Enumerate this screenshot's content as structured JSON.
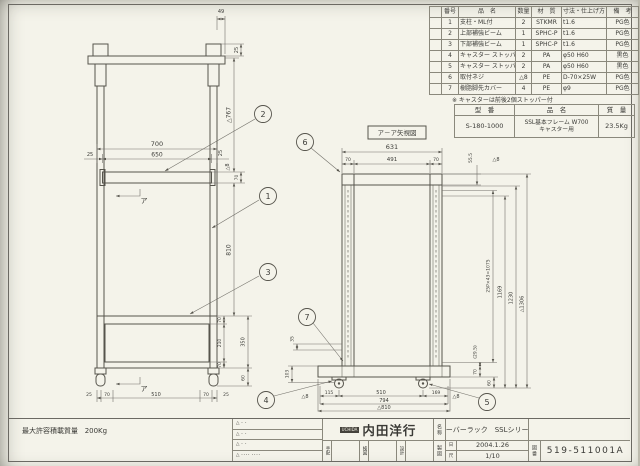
{
  "colors": {
    "paper": "#f4f3ea",
    "line": "#56544c",
    "dim": "#73716a",
    "text": "#3a3a36"
  },
  "front_view": {
    "callouts": {
      "c1": "1",
      "c2": "2",
      "c3": "3"
    },
    "section_label": "ア",
    "dims": {
      "d49": "49",
      "d25cap": "25",
      "d767": "△767",
      "d700": "700",
      "d650": "650",
      "d25l": "25",
      "d25r": "25",
      "d8": "△8",
      "d70beam": "70",
      "d810": "810",
      "d70a": "70",
      "d210": "210",
      "d70b": "70",
      "d350": "350",
      "d60": "60",
      "b25l": "25",
      "b70l": "70",
      "b510": "510",
      "b70r": "70",
      "b25r": "25"
    }
  },
  "side_view": {
    "title": "ア－ア矢視図",
    "callouts": {
      "c4": "4",
      "c5": "5",
      "c6": "6",
      "c7": "7"
    },
    "dims": {
      "d631": "631",
      "d70l": "70",
      "d491": "491",
      "d70r": "70",
      "d55": "55.5",
      "d8top": "△8",
      "pitch": "25P×43=1075",
      "d1169": "1169",
      "d1230": "1230",
      "d1306": "△1306",
      "d29": "(29.5)",
      "d70base": "70",
      "d60": "60",
      "d35": "35",
      "d103": "103",
      "d8l": "△8",
      "d8r": "△8",
      "b115": "115",
      "b510": "510",
      "b169": "169",
      "b794": "794",
      "b810": "△810"
    }
  },
  "parts_table": {
    "headers": {
      "sym": "",
      "no": "番号",
      "name": "品　名",
      "qty": "数量",
      "mat": "材　質",
      "dim": "寸法・仕上げ方",
      "note": "備　考"
    },
    "rows": [
      {
        "sym": "",
        "no": "1",
        "name": "支柱・ML付",
        "qty": "2",
        "mat": "STKMR",
        "dim": "t1.6",
        "note": "PG色"
      },
      {
        "sym": "",
        "no": "2",
        "name": "上部補強ビーム",
        "qty": "1",
        "mat": "SPHC-P",
        "dim": "t1.6",
        "note": "PG色"
      },
      {
        "sym": "",
        "no": "3",
        "name": "下部補強ビーム",
        "qty": "1",
        "mat": "SPHC-P",
        "dim": "t1.6",
        "note": "PG色"
      },
      {
        "sym": "",
        "no": "4",
        "name": "キャスター ストッパー付",
        "qty": "2",
        "mat": "PA",
        "dim": "φ50 H60",
        "note": "黒色"
      },
      {
        "sym": "",
        "no": "5",
        "name": "キャスター ストッパーなし",
        "qty": "2",
        "mat": "PA",
        "dim": "φ50 H60",
        "note": "黒色"
      },
      {
        "sym": "",
        "no": "6",
        "name": "取付ネジ",
        "qty": "△8",
        "mat": "PE",
        "dim": "D-70×25W",
        "note": "PG色"
      },
      {
        "sym": "",
        "no": "7",
        "name": "樹脂脚先カバー",
        "qty": "4",
        "mat": "PE",
        "dim": "φ9",
        "note": "PG色"
      }
    ],
    "note": "※ キャスターは前後2個ストッパー付"
  },
  "model_table": {
    "h_model": "型　番",
    "h_name": "品　名",
    "h_weight": "質　量",
    "model": "S-180-1000",
    "name_l1": "SSL基本フレーム W700",
    "name_l2": "キャスター用",
    "weight": "23.5Kg"
  },
  "title_block": {
    "load_label": "最大許容積載質量",
    "load_value": "200Kg",
    "revisions": [
      "△ ･ ･",
      "△ ･ ･",
      "△ ･ ･",
      "△ ････ ････"
    ],
    "stamps": [
      "手配",
      "検図",
      "設計"
    ],
    "logo_badge": "UCHIDA",
    "company": "内田洋行",
    "name_label": "名称",
    "name_value": "サーバーラック　SSLシリーズ",
    "draft_label": "製図",
    "date_label": "日",
    "date_value": "2004.1.26",
    "scale_label": "尺",
    "scale_value": "1/10",
    "dwg_label": "図番",
    "dwg_no": "519-511001A"
  }
}
